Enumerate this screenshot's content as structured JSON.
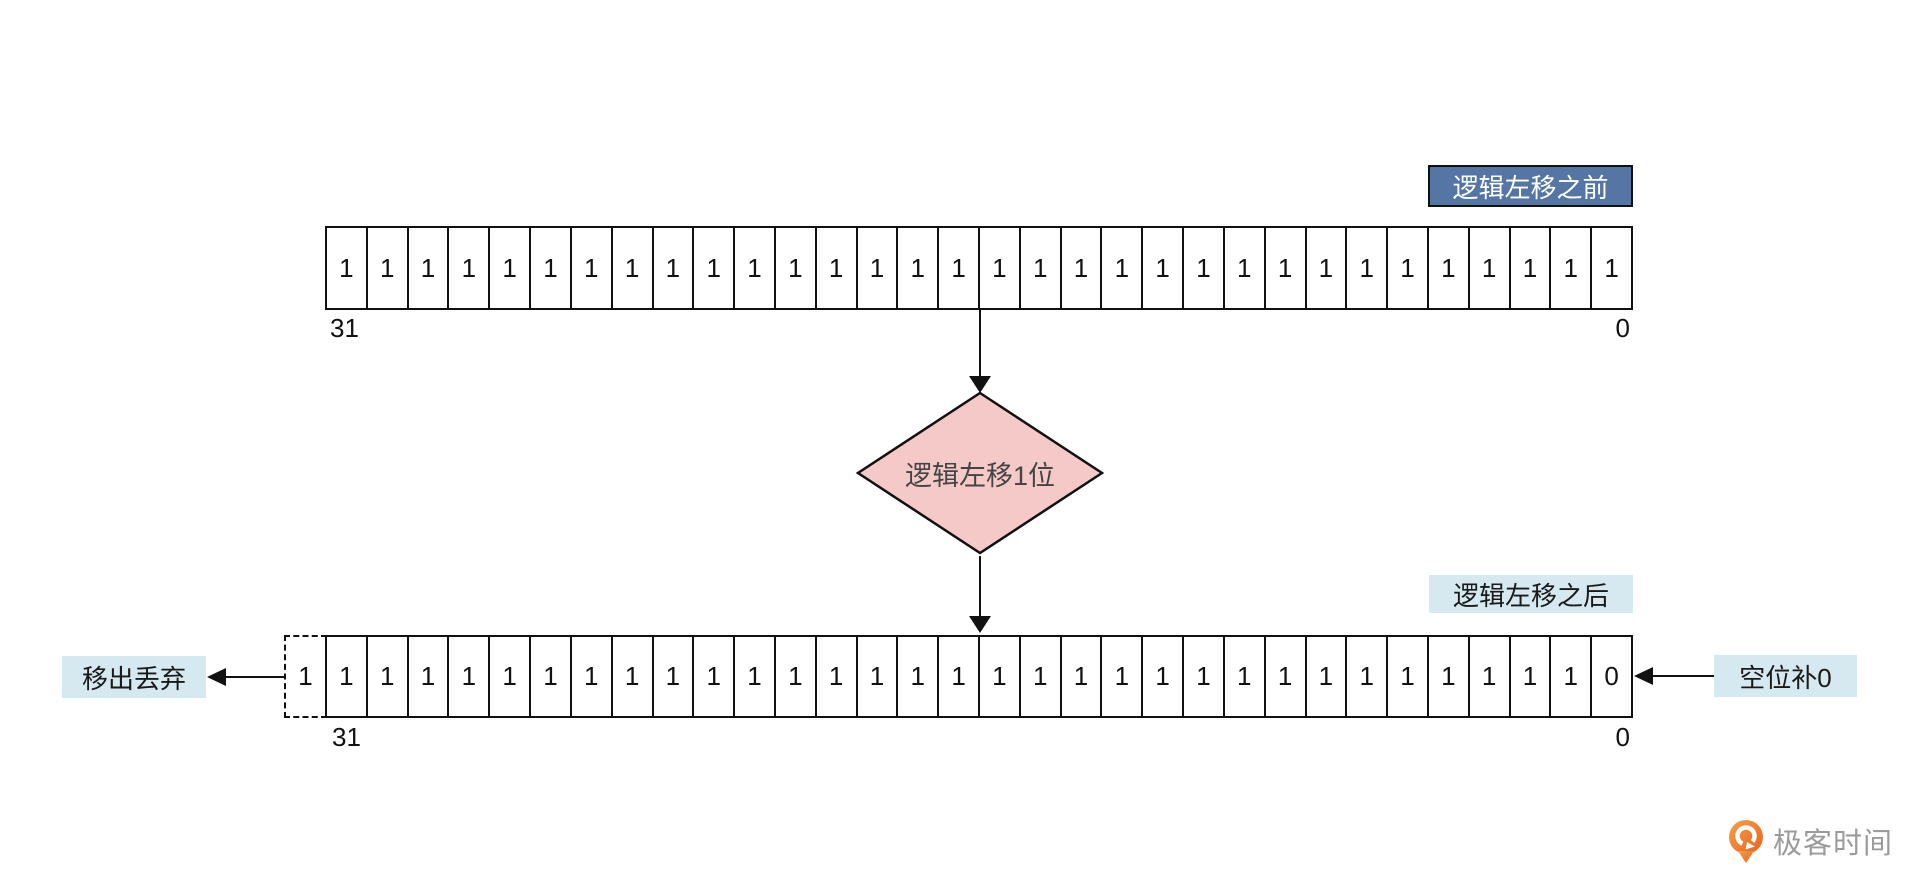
{
  "colors": {
    "title_blue": "#5575a5",
    "label_light_blue": "#d6e8f0",
    "diamond_pink": "#f5c9c7",
    "line_black": "#111111",
    "logo_orange": "#ed7026",
    "logo_text_gray": "#9b9b9b"
  },
  "before": {
    "title": "逻辑左移之前",
    "bits": [
      "1",
      "1",
      "1",
      "1",
      "1",
      "1",
      "1",
      "1",
      "1",
      "1",
      "1",
      "1",
      "1",
      "1",
      "1",
      "1",
      "1",
      "1",
      "1",
      "1",
      "1",
      "1",
      "1",
      "1",
      "1",
      "1",
      "1",
      "1",
      "1",
      "1",
      "1",
      "1"
    ],
    "index_left": "31",
    "index_right": "0"
  },
  "operation": {
    "label": "逻辑左移1位"
  },
  "after": {
    "title": "逻辑左移之后",
    "shifted_out_bit": "1",
    "bits": [
      "1",
      "1",
      "1",
      "1",
      "1",
      "1",
      "1",
      "1",
      "1",
      "1",
      "1",
      "1",
      "1",
      "1",
      "1",
      "1",
      "1",
      "1",
      "1",
      "1",
      "1",
      "1",
      "1",
      "1",
      "1",
      "1",
      "1",
      "1",
      "1",
      "1",
      "1",
      "0"
    ],
    "index_left": "31",
    "index_right": "0"
  },
  "annotations": {
    "shift_out_label": "移出丢弃",
    "fill_zero_label": "空位补0"
  },
  "logo": {
    "text": "极客时间"
  }
}
